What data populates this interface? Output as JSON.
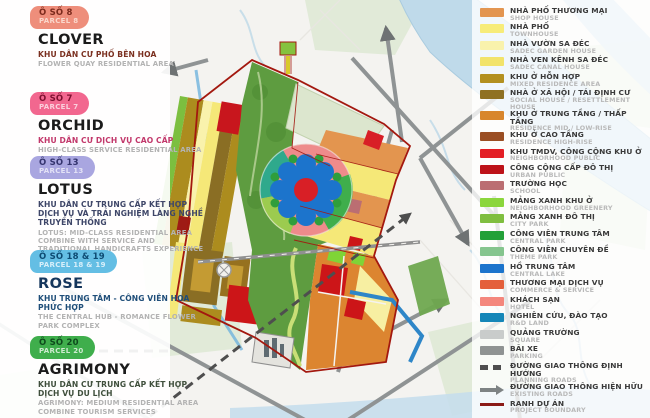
{
  "parcels": [
    {
      "badge_line1": "Ô SỐ 8",
      "badge_line2": "PARCEL 8",
      "name": "CLOVER",
      "vn": "KHU DÂN CƯ PHỐ BÊN HOA",
      "en": "FLOWER QUAY RESIDENTIAL AREA",
      "badge_color": "#EE8E7B",
      "badge_text": "#7B2A1C",
      "badge_sub": "#FAD7CB",
      "vn_color": "#7B3020",
      "name_color": "#1b1b1b"
    },
    {
      "badge_line1": "Ô SỐ 7",
      "badge_line2": "PARCEL 7",
      "name": "ORCHID",
      "vn": "KHU DÂN CƯ DỊCH VỤ CAO CẤP",
      "en": "HIGH-CLASS SERVICE RESIDENTIAL AREA",
      "badge_color": "#F2678F",
      "badge_text": "#7E1030",
      "badge_sub": "#FAD0DC",
      "vn_color": "#C2386B",
      "name_color": "#1b1b1b"
    },
    {
      "badge_line1": "Ô SỐ 13",
      "badge_line2": "PARCEL 13",
      "name": "LOTUS",
      "vn": "KHU DÂN CƯ TRUNG CẤP KẾT HỢP DỊCH VỤ VÀ TRẢI NGHIỆM LÀNG NGHỀ TRUYỀN THỐNG",
      "en": "LOTUS: MID-CLASS RESIDENTIAL AREA COMBINE WITH SERVICE AND TRADITIONAL HANDICRAFTS EXPERIENCE",
      "badge_color": "#A9A6E0",
      "badge_text": "#34346E",
      "badge_sub": "#E3E2F6",
      "vn_color": "#3E4668",
      "name_color": "#1b1b1b"
    },
    {
      "badge_line1": "Ô SỐ 18 & 19",
      "badge_line2": "PARCEL 18 & 19",
      "name": "ROSE",
      "vn": "KHU TRUNG TÂM -  CÔNG VIÊN HOA PHỨC HỢP",
      "en": "THE CENTRAL HUB - ROMANCE FLOWER PARK COMPLEX",
      "badge_color": "#64BEE4",
      "badge_text": "#0E4B73",
      "badge_sub": "#D8EFFA",
      "vn_color": "#1F4E79",
      "name_color": "#15365C"
    },
    {
      "badge_line1": "Ô SỐ 20",
      "badge_line2": "PARCEL 20",
      "name": "AGRIMONY",
      "vn": "KHU DÂN CƯ  TRUNG CẤP KẾT HỢP DỊCH VỤ DU LỊCH",
      "en": "AGRIMONY: MEDIUM RESIDENTIAL AREA COMBINE TOURISM SERVICES",
      "badge_color": "#3FAE4C",
      "badge_text": "#0E4A1C",
      "badge_sub": "#CDEBCF",
      "vn_color": "#3F4F3C",
      "name_color": "#1b1b1b"
    }
  ],
  "legend": [
    {
      "vn": "NHÀ PHỐ THƯƠNG MẠI",
      "en": "SHOP HOUSE",
      "color": "#E3954F",
      "symbol": "swatch"
    },
    {
      "vn": "NHÀ PHỐ",
      "en": "TOWNHOUSE",
      "color": "#F7EC79",
      "symbol": "swatch"
    },
    {
      "vn": "NHÀ VƯỜN SA ĐÉC",
      "en": "SADEC GARDEN HOUSE",
      "color": "#F9F2AC",
      "symbol": "swatch"
    },
    {
      "vn": "NHÀ VEN KÊNH SA ĐÉC",
      "en": "SADEC CANAL HOUSE",
      "color": "#F2E36A",
      "symbol": "swatch"
    },
    {
      "vn": "KHU Ở HỖN HỢP",
      "en": "MIXED RESIDENCE AREA",
      "color": "#B3901F",
      "symbol": "swatch"
    },
    {
      "vn": "NHÀ Ở XÃ HỘI / TÁI ĐỊNH CƯ",
      "en": "SOCIAL HOUSE / RESETTLEMENT HOUSE",
      "color": "#8F7122",
      "symbol": "swatch"
    },
    {
      "vn": "KHU Ở TRUNG TẦNG / THẤP TẦNG",
      "en": "RESIDENCE MID / LOW-RISE",
      "color": "#D8862C",
      "symbol": "swatch"
    },
    {
      "vn": "KHU Ở CAO TẦNG",
      "en": "RESIDENCE HIGH-RISE",
      "color": "#9A4E23",
      "symbol": "swatch"
    },
    {
      "vn": "KHU TMDV, CÔNG CỘNG KHU Ở",
      "en": "NEIGHBORHOOD PUBLIC",
      "color": "#E31E24",
      "symbol": "swatch"
    },
    {
      "vn": "CÔNG CỘNG CẤP ĐÔ THỊ",
      "en": "URBAN PUBLIC",
      "color": "#BD1218",
      "symbol": "swatch"
    },
    {
      "vn": "TRƯỜNG HỌC",
      "en": "SCHOOL",
      "color": "#BB6E72",
      "symbol": "swatch"
    },
    {
      "vn": "MẢNG XANH KHU Ở",
      "en": "NEIGHBORHOOD GREENERY",
      "color": "#8BD63C",
      "symbol": "swatch"
    },
    {
      "vn": "MẢNG XANH ĐÔ THỊ",
      "en": "CITY PARK",
      "color": "#7FBE3F",
      "symbol": "swatch"
    },
    {
      "vn": "CÔNG VIÊN TRUNG TÂM",
      "en": "CENTRAL PARK",
      "color": "#22A038",
      "symbol": "swatch"
    },
    {
      "vn": "CÔNG VIÊN CHUYÊN ĐỀ",
      "en": "THEME PARK",
      "color": "#85C58E",
      "symbol": "swatch"
    },
    {
      "vn": "HỒ TRUNG TÂM",
      "en": "CENTRAL LAKE",
      "color": "#1C74CC",
      "symbol": "swatch"
    },
    {
      "vn": "THƯƠNG MẠI DỊCH VỤ",
      "en": "COMMERCE & SERVICE",
      "color": "#E45F3B",
      "symbol": "swatch"
    },
    {
      "vn": "KHÁCH SẠN",
      "en": "HOTEL",
      "color": "#F4877D",
      "symbol": "swatch"
    },
    {
      "vn": "NGHIÊN CỨU, ĐÀO TẠO",
      "en": "R&D LAND",
      "color": "#1586B8",
      "symbol": "swatch"
    },
    {
      "vn": "QUẢNG TRƯỜNG",
      "en": "SQUARE",
      "color": "#C9CCCB",
      "symbol": "swatch"
    },
    {
      "vn": "BÃI XE",
      "en": "PARKING",
      "color": "#8F9392",
      "symbol": "swatch"
    },
    {
      "vn": "ĐƯỜNG GIAO THÔNG ĐỊNH HƯỚNG",
      "en": "PLANNING ROADS",
      "color": "#4E4E4E",
      "symbol": "dashed-road"
    },
    {
      "vn": "ĐƯỜNG GIAO THÔNG HIỆN HỮU",
      "en": "EXISTING ROADS",
      "color": "#7E8384",
      "symbol": "arrow-road"
    },
    {
      "vn": "RANH DỰ ÁN",
      "en": "PROJECT BOUNDARY",
      "color": "#8B1A18",
      "symbol": "boundary-line"
    }
  ]
}
